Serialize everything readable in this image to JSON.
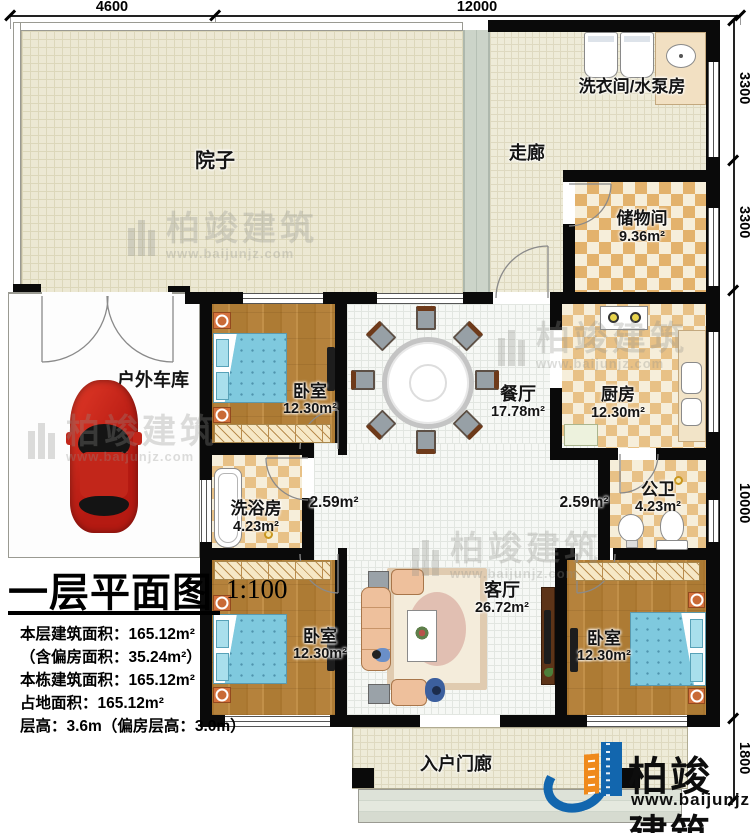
{
  "plan": {
    "title": "一层平面图",
    "scale": "1:100",
    "stats": [
      "本层建筑面积：165.12m²",
      "（含偏房面积：35.24m²）",
      "本栋建筑面积：165.12m²",
      "占地面积：165.12m²",
      "层高：3.6m（偏房层高：3.0m）"
    ]
  },
  "dims": {
    "top": [
      "4600",
      "12000"
    ],
    "right": [
      "3300",
      "3300",
      "10000",
      "1800"
    ]
  },
  "rooms": {
    "yard": {
      "label": "院子"
    },
    "corridor": {
      "label": "走廊"
    },
    "laundry": {
      "label": "洗衣间/水泵房"
    },
    "storage": {
      "label": "储物间",
      "area": "9.36m²"
    },
    "garage": {
      "label": "户外车库"
    },
    "bedroom1": {
      "label": "卧室",
      "area": "12.30m²"
    },
    "dining": {
      "label": "餐厅",
      "area": "17.78m²"
    },
    "kitchen": {
      "label": "厨房",
      "area": "12.30m²"
    },
    "bath": {
      "label": "洗浴房",
      "area": "4.23m²"
    },
    "hall_left": {
      "area": "2.59m²"
    },
    "hall_right": {
      "area": "2.59m²"
    },
    "wc": {
      "label": "公卫",
      "area": "4.23m²"
    },
    "bedroom2": {
      "label": "卧室",
      "area": "12.30m²"
    },
    "living": {
      "label": "客厅",
      "area": "26.72m²"
    },
    "bedroom3": {
      "label": "卧室",
      "area": "12.30m²"
    },
    "porch": {
      "label": "入户门廊"
    }
  },
  "brand": {
    "name": "柏竣建筑",
    "site": "www.baijunjz.com"
  },
  "watermark": {
    "name": "柏竣建筑",
    "site": "www.baijunjz.com"
  },
  "colors": {
    "brand_blue": "#1266ae",
    "brand_orange": "#ef8a1c",
    "wall": "#0a0a0a",
    "checker": "#e8c186"
  }
}
